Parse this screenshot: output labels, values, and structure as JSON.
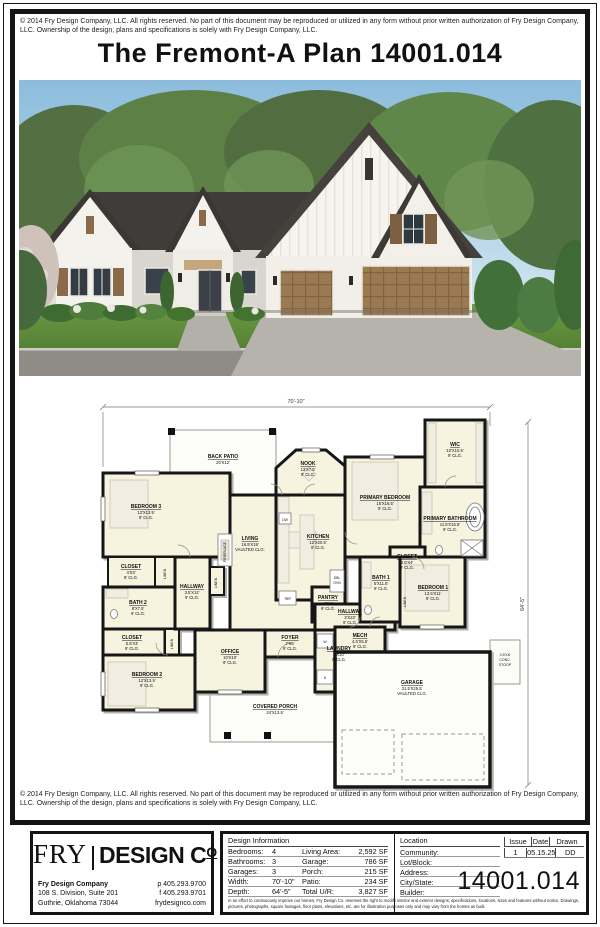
{
  "page": {
    "copyright": "© 2014 Fry Design Company, LLC. All rights reserved. No part of this document may be reproduced or utilized in any form without prior written authorization of Fry Design Company, LLC. Ownership of the design, plans and specifications is solely with Fry Design Company, LLC.",
    "title": "The Fremont-A Plan 14001.014"
  },
  "floor_plan": {
    "dims": {
      "width": "70'-10\"",
      "depth": "64'-5\""
    },
    "rooms": [
      {
        "n": "BACK PATIO",
        "d": "20'X12'",
        "c": ""
      },
      {
        "n": "BEDROOM 3",
        "d": "12'X13.5'",
        "c": "9' CLG."
      },
      {
        "n": "CLOSET",
        "d": "4'X3'",
        "c": "9' CLG."
      },
      {
        "n": "BATH 2",
        "d": "8'X7.5'",
        "c": "9' CLG."
      },
      {
        "n": "HALLWAY",
        "d": "3.5'X12'",
        "c": "9' CLG."
      },
      {
        "n": "CLOSET",
        "d": "5.5'X3'",
        "c": "9' CLG."
      },
      {
        "n": "BEDROOM 2",
        "d": "12'X13.5'",
        "c": "9' CLG."
      },
      {
        "n": "LIVING",
        "d": "16.5'X19'",
        "c": "VAULTED CLG."
      },
      {
        "n": "NOOK",
        "d": "13'X7.5'",
        "c": "9' CLG."
      },
      {
        "n": "KITCHEN",
        "d": "12'X20.5'",
        "c": "9' CLG."
      },
      {
        "n": "PANTRY",
        "d": "4'X4'",
        "c": "9' CLG."
      },
      {
        "n": "OFFICE",
        "d": "10'X10'",
        "c": "9' CLG."
      },
      {
        "n": "FOYER",
        "d": "7'X5'",
        "c": "9' CLG."
      },
      {
        "n": "LAUNDRY",
        "d": "7'X10'",
        "c": "9' CLG."
      },
      {
        "n": "HALLWAY",
        "d": "3'X23'",
        "c": "9' CLG."
      },
      {
        "n": "PRIMARY BEDROOM",
        "d": "15'X16.5'",
        "c": "9' CLG."
      },
      {
        "n": "WIC",
        "d": "10'X10.5'",
        "c": "9' CLG."
      },
      {
        "n": "PRIMARY BATHROOM",
        "d": "11.5'X15.5'",
        "c": "9' CLG."
      },
      {
        "n": "CLOSET",
        "d": "3.5'X4'",
        "c": "9' CLG."
      },
      {
        "n": "BATH 1",
        "d": "5'X11.5'",
        "c": "9' CLG."
      },
      {
        "n": "BEDROOM 1",
        "d": "13.5'X11'",
        "c": "9' CLG."
      },
      {
        "n": "MECH",
        "d": "4.5'X5.5'",
        "c": "9' CLG."
      },
      {
        "n": "GARAGE",
        "d": "31.5'X25.5'",
        "c": "VAULTED CLG."
      },
      {
        "n": "COVERED PORCH",
        "d": "24'X13.5'",
        "c": ""
      }
    ],
    "labels": {
      "linen": "LINEN",
      "fireplace": "FIREPLACE",
      "dw": "DW",
      "ref": "REF",
      "dbl": "DBL",
      "ovn": "OVN",
      "washer": "W",
      "dryer": "D",
      "stoop1": "3.5'X8'",
      "stoop2": "CONC.",
      "stoop3": "STOOP"
    }
  },
  "footer": {
    "logo": {
      "fry": "FRY",
      "design": "DESIGN C",
      "o": "O"
    },
    "company": {
      "name": "Fry Design Company",
      "address1": "108 S. Division, Suite 201",
      "address2": "Guthrie, Oklahoma 73044",
      "phone": "p 405.293.9700",
      "fax": "f 405.293.9701",
      "web": "frydesignco.com"
    },
    "design_info": {
      "header": "Design Information",
      "rows": [
        {
          "l": "Bedrooms:",
          "v": "4",
          "l2": "Living Area:",
          "v2": "2,592 SF"
        },
        {
          "l": "Bathrooms:",
          "v": "3",
          "l2": "Garage:",
          "v2": "786 SF"
        },
        {
          "l": "Garages:",
          "v": "3",
          "l2": "Porch:",
          "v2": "215 SF"
        },
        {
          "l": "Width:",
          "v": "70'-10\"",
          "l2": "Patio:",
          "v2": "234 SF"
        },
        {
          "l": "Depth:",
          "v": "64'-5\"",
          "l2": "Total U/R:",
          "v2": "3,827 SF"
        }
      ]
    },
    "location": {
      "header": "Location",
      "rows": [
        "Community:",
        "Lot/Block:",
        "Address:",
        "City/State:",
        "Builder:"
      ]
    },
    "issue_table": {
      "headers": [
        "Issue",
        "Date",
        "Drawn"
      ],
      "values": [
        "1",
        "05.15.25",
        "DD"
      ]
    },
    "plan_number": "14001.014",
    "disclaimer": "In an effort to continuously improve our homes, Fry Design Co. reserves the right to modify interior and exterior designs, specifications, locations, sizes and features without notice. Drawings, pictures, photographs, square footages, floor plans, elevations, etc. are for illustration purposes only and may vary from the homes as built."
  }
}
